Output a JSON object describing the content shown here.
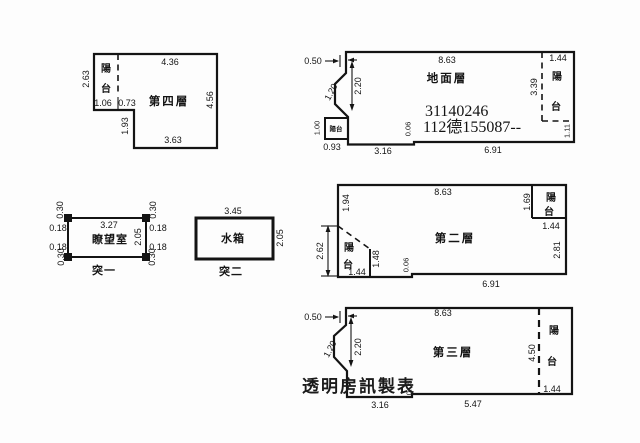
{
  "floor4": {
    "label": "第四層",
    "balcony": "陽台",
    "dim_top": "4.36",
    "dim_left": "2.63",
    "dim_balcony_width": "1.06",
    "dim_balcony_to_step": "0.73",
    "dim_step": "1.93",
    "dim_bottom": "3.63",
    "dim_right": "4.56"
  },
  "lookout": {
    "label": "瞭望室",
    "caption": "突一",
    "dim_top": "3.27",
    "dim_height": "2.05",
    "corner_tl_v": "0.30",
    "corner_tl_h": "0.18",
    "corner_bl_h": "0.18",
    "corner_bl_v": "0.30",
    "corner_tr_v": "0.30",
    "corner_tr_h": "0.18",
    "corner_br_h": "0.18",
    "corner_br_v": "0.30"
  },
  "tank": {
    "label": "水箱",
    "caption": "突二",
    "dim_top": "3.45",
    "dim_height": "2.05"
  },
  "ground": {
    "label": "地面層",
    "stamp_line1": "31140246",
    "stamp_line2": "112德155087--",
    "dim_offset": "0.50",
    "dim_top": "8.63",
    "balcony_right": "陽台",
    "dim_balcony_right_width": "1.44",
    "dim_balcony_right_height": "3.39",
    "dim_balcony_right_bottom": "1.11",
    "dim_slant": "1.20",
    "dim_inner_height": "2.20",
    "balcony_small": "陽台",
    "dim_balcony_small_height": "1.00",
    "dim_balcony_small_width": "0.93",
    "dim_bottom_left": "3.16",
    "dim_jog": "0.06",
    "dim_bottom_right": "6.91"
  },
  "floor2": {
    "label": "第二層",
    "dim_top": "8.63",
    "dim_left_upper": "1.94",
    "balcony_tr": "陽台",
    "dim_balcony_tr_height": "1.69",
    "dim_balcony_tr_width": "1.44",
    "dim_right": "2.81",
    "balcony_bl": "陽台",
    "dim_balcony_bl_span": "2.62",
    "dim_balcony_bl_width": "1.44",
    "dim_balcony_bl_height": "1.48",
    "dim_jog": "0.06",
    "dim_bottom": "6.91"
  },
  "floor3": {
    "label": "第三層",
    "dim_offset": "0.50",
    "dim_top": "8.63",
    "dim_slant": "1.20",
    "dim_inner_height": "2.20",
    "balcony": "陽台",
    "dim_balcony_height": "4.50",
    "dim_balcony_width": "1.44",
    "dim_bottom_left": "3.16",
    "dim_jog": "0.06",
    "dim_bottom_right": "5.47"
  },
  "watermark": "透明房訊製表"
}
